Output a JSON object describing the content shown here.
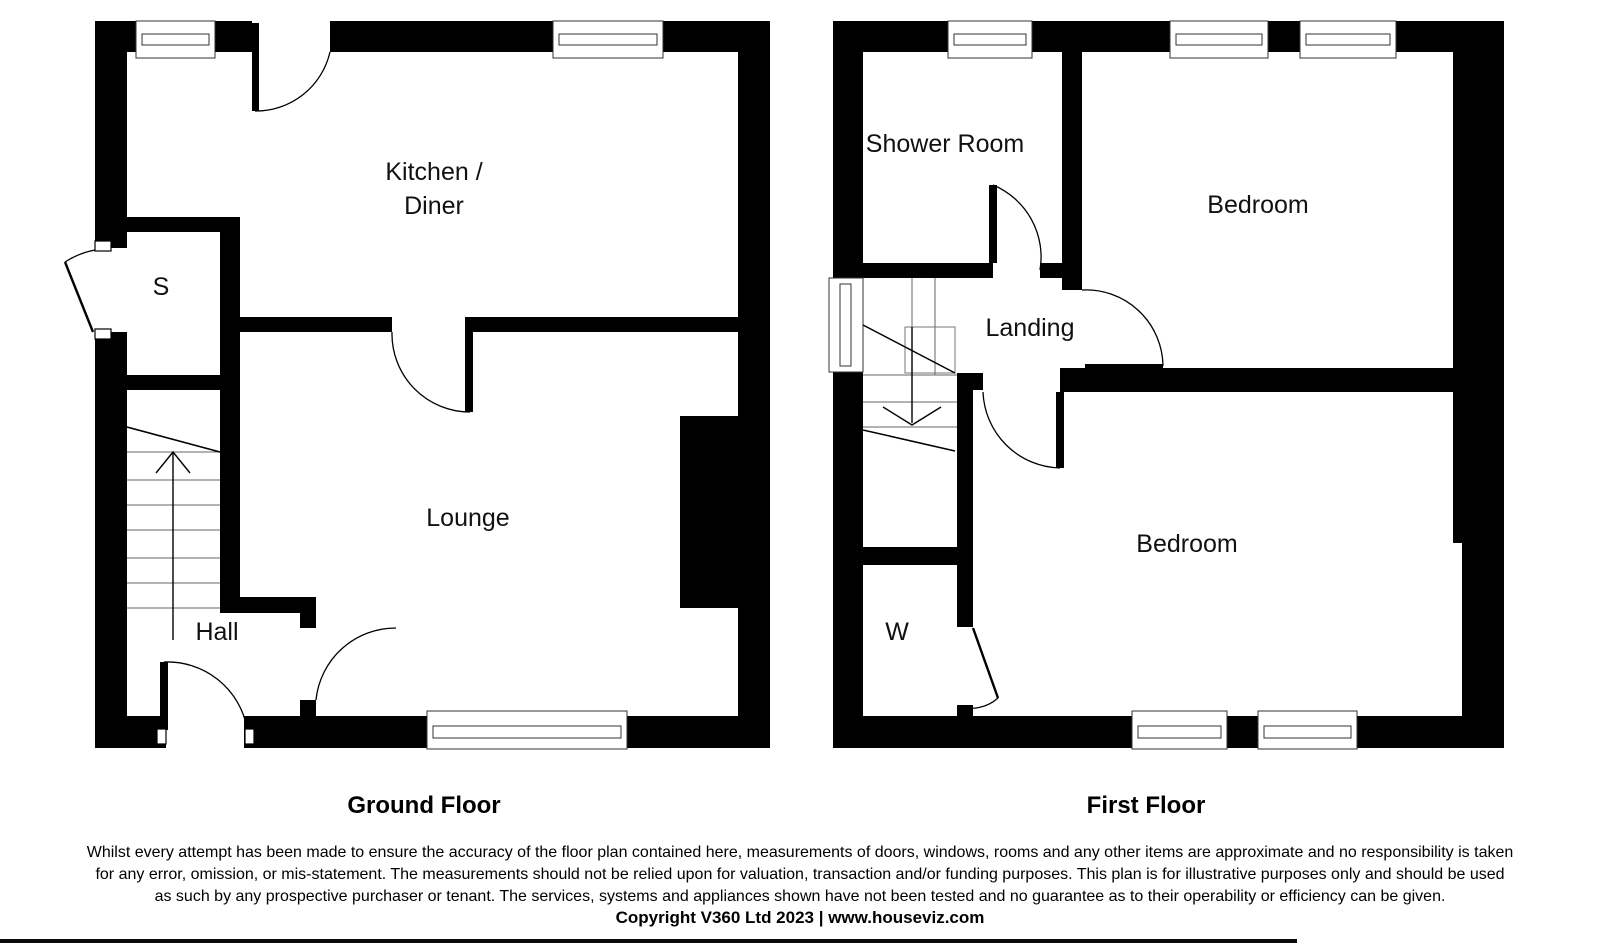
{
  "ground_floor": {
    "title": "Ground Floor",
    "rooms": {
      "kitchen_line1": "Kitchen /",
      "kitchen_line2": "Diner",
      "store": "S",
      "lounge": "Lounge",
      "hall": "Hall"
    }
  },
  "first_floor": {
    "title": "First Floor",
    "rooms": {
      "shower_room": "Shower Room",
      "bedroom_front": "Bedroom",
      "landing": "Landing",
      "bedroom_back": "Bedroom",
      "wardrobe": "W"
    }
  },
  "footer": {
    "disclaimer_lines": [
      "Whilst every attempt has been made to ensure the accuracy of the floor plan contained here, measurements of doors, windows, rooms and any other items are approximate and no responsibility is taken",
      "for any error, omission, or mis-statement. The measurements should not be relied upon for valuation, transaction and/or funding purposes. This plan is for illustrative purposes only and should be used",
      "as such by any prospective purchaser or tenant. The services, systems and appliances shown have not been tested and no guarantee as to their operability or efficiency can be given."
    ],
    "copyright": "Copyright V360 Ltd 2023 | www.houseviz.com"
  },
  "colors": {
    "wall": "#000000",
    "background": "#ffffff"
  }
}
